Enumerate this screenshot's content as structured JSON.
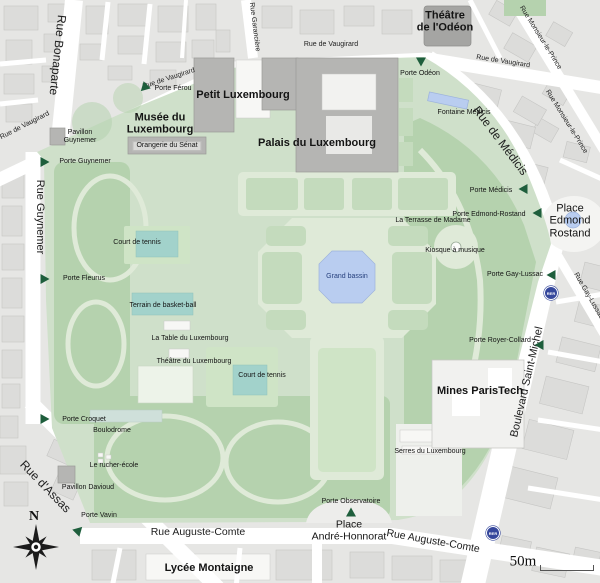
{
  "colors": {
    "garden_green": "#cfe0ca",
    "bosquet_green": "#b5d2ae",
    "parterre_green": "#c4dbbd",
    "lawn_green": "#cfe4c6",
    "path_green": "#dfead8",
    "water_blue": "#b9cdf0",
    "court_teal": "#a2d2cb",
    "gate_green": "#1e5e3c",
    "building_gray": "#b5b5b3",
    "dark_building_gray": "#a5a5a3",
    "city_block": "#e6e6e4",
    "city_building": "#dcdcda",
    "street_white": "#ffffff",
    "rer_blue": "#35479c",
    "bassin_text": "#27417e"
  },
  "streets": {
    "bonaparte": "Rue Bonaparte",
    "vaugirard": "Rue de Vaugirard",
    "garanciere": "Rue Garancière",
    "monsieur_le_prince": "Rue Monsieur-le-Prince",
    "medicis": "Rue de Médicis",
    "guynemer": "Rue Guynemer",
    "assas": "Rue d'Assas",
    "saint_michel": "Boulevard Saint-Michel",
    "gay_lussac": "Rue Gay-Lussac",
    "auguste_comte": "Rue Auguste-Comte"
  },
  "gates": {
    "ferou": "Porte Férou",
    "guynemer": "Porte Guynemer",
    "fleurus": "Porte Fleurus",
    "croquet": "Porte Croquet",
    "vavin": "Porte Vavin",
    "odeon": "Porte Odéon",
    "medicis": "Porte Médicis",
    "edmond_rostand": "Porte Edmond-Rostand",
    "gay_lussac": "Porte Gay-Lussac",
    "royer_collard": "Porte Royer-Collard",
    "observatoire": "Porte Observatoire"
  },
  "places": {
    "edmond_rostand": "Place\nEdmond\nRostand",
    "andre_honnorat": "Place\nAndré-Honnorat"
  },
  "landmarks": {
    "theatre_odeon": "Théâtre\nde l'Odéon",
    "petit_luxembourg": "Petit Luxembourg",
    "musee": "Musée du\nLuxembourg",
    "palais": "Palais du Luxembourg",
    "orangerie": "Orangerie du Sénat",
    "mines": "Mines ParisTech",
    "lycee": "Lycée Montaigne",
    "serres": "Serres du Luxembourg",
    "pavillon_guynemer": "Pavillon\nGuynemer",
    "pavillon_davioud": "Pavillon Davioud"
  },
  "features": {
    "fontaine_medicis": "Fontaine Médicis",
    "terrasse_madame": "La Terrasse de Madame",
    "kiosque": "Kiosque à musique",
    "grand_bassin": "Grand bassin",
    "court_tennis": "Court de tennis",
    "basket": "Terrain de basket-ball",
    "table": "La Table du Luxembourg",
    "theatre_lux": "Théâtre du Luxembourg",
    "boulodrome": "Boulodrome",
    "rucher": "Le rucher-école"
  },
  "transit": {
    "rer": "RER"
  },
  "scale": {
    "label": "50m"
  },
  "compass": {
    "north": "N"
  }
}
